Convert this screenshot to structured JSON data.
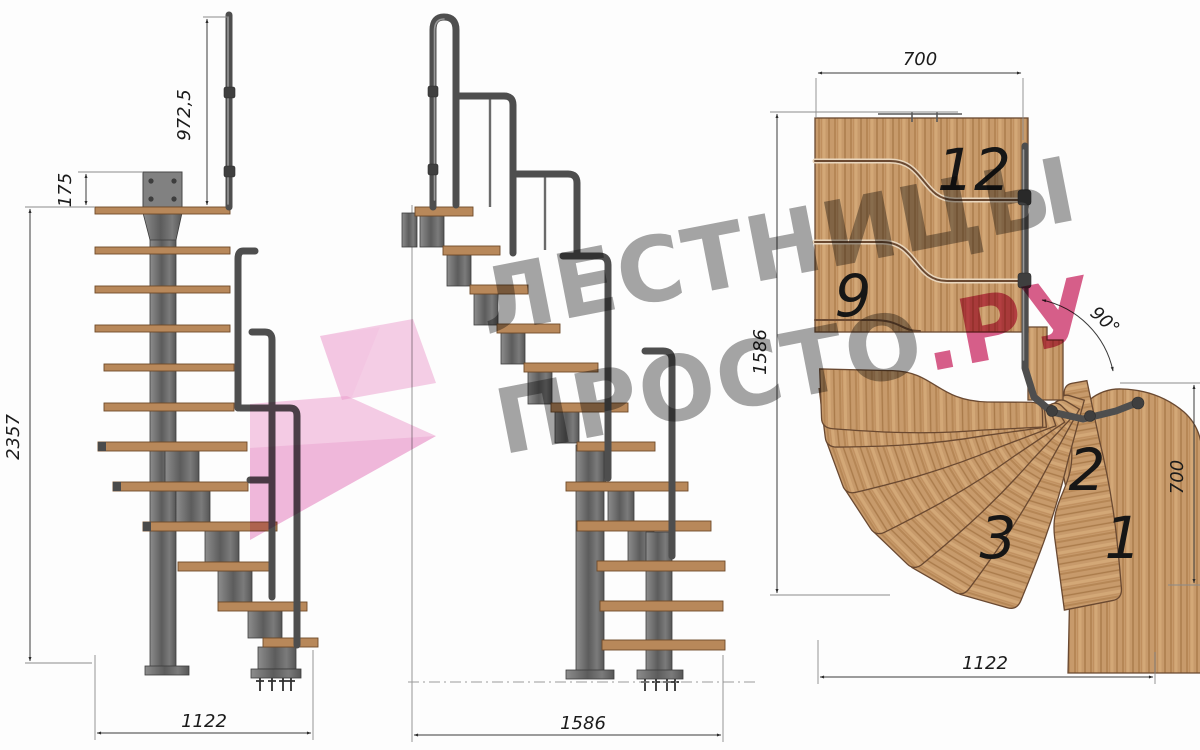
{
  "watermark": {
    "line1": "ЛЕСТНИЦЫ",
    "line2_gray": "ПРОСТО",
    "line2_accent": ".РУ"
  },
  "colors": {
    "watermark_gray": "#989898",
    "watermark_pink": "#d3497a",
    "arrow_pink": "#eea2d0",
    "wood": "#c79a6b",
    "wood_edge": "#6a4931",
    "metal": "#565656",
    "dimension_line": "#3a3a3a"
  },
  "front_view": {
    "dim_rail_height": "972,5",
    "dim_plate_height": "175",
    "dim_total_height": "2357",
    "dim_width": "1122"
  },
  "side_view": {
    "dim_length": "1586"
  },
  "plan_view": {
    "dim_top_width": "700",
    "dim_left_height": "1586",
    "dim_right_depth": "700",
    "dim_bottom_width": "1122",
    "dim_angle": "90°",
    "steps": {
      "s12": "12",
      "s9": "9",
      "s3": "3",
      "s2": "2",
      "s1": "1"
    }
  }
}
